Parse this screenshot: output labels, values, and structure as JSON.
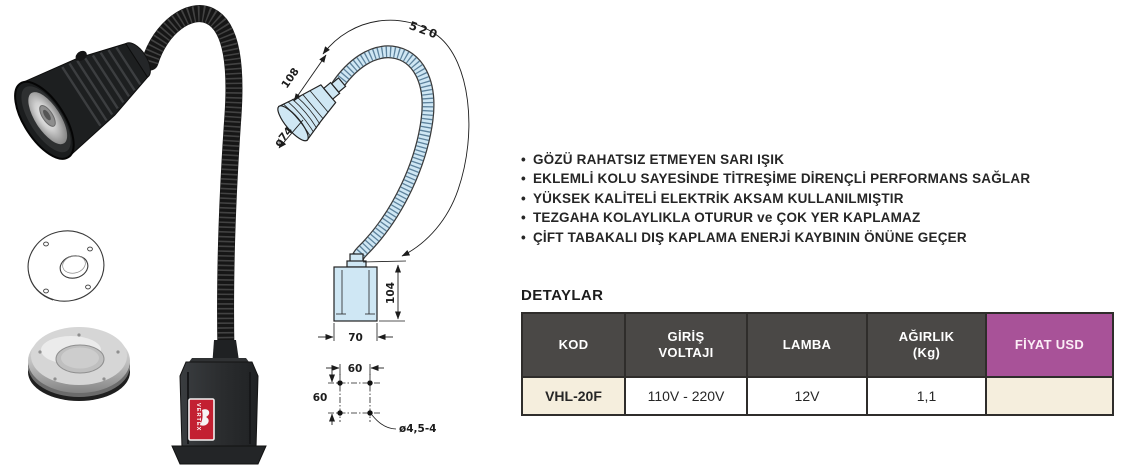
{
  "features": {
    "bullet": "•",
    "items": [
      "GÖZÜ RAHATSIZ ETMEYEN SARI IŞIK",
      "EKLEMLİ KOLU SAYESİNDE TİTREŞİME DİRENÇLİ PERFORMANS SAĞLAR",
      "YÜKSEK KALİTELİ ELEKTRİK AKSAM KULLANILMIŞTIR",
      "TEZGAHA KOLAYLIKLA OTURUR ve ÇOK YER KAPLAMAZ",
      "ÇİFT TABAKALI DIŞ KAPLAMA ENERJİ KAYBININ ÖNÜNE GEÇER"
    ]
  },
  "details": {
    "title": "DETAYLAR",
    "headers": [
      "KOD",
      "GİRİŞ VOLTAJI",
      "LAMBA",
      "AĞIRLIK (Kg)",
      "FİYAT USD"
    ],
    "row": {
      "kod": "VHL-20F",
      "giris_voltaji": "110V - 220V",
      "lamba": "12V",
      "agirlik": "1,1",
      "fiyat": ""
    }
  },
  "drawing": {
    "dims": {
      "arm_length": "520",
      "head_length": "108",
      "head_diameter": "ø74",
      "base_height": "104",
      "base_width": "70",
      "hole_spacing_x": "60",
      "hole_spacing_y": "60",
      "hole_spec": "ø4,5-4"
    }
  },
  "photo": {
    "brand_label": "VERTEX"
  },
  "colors": {
    "table_header_bg": "#4a4846",
    "price_header_bg": "#a85298",
    "cream_cell_bg": "#f5eedd",
    "table_border": "#2f2d2b",
    "text": "#262626",
    "drawing_fill": "#cfe7f4",
    "brand_label_red": "#c32032"
  }
}
